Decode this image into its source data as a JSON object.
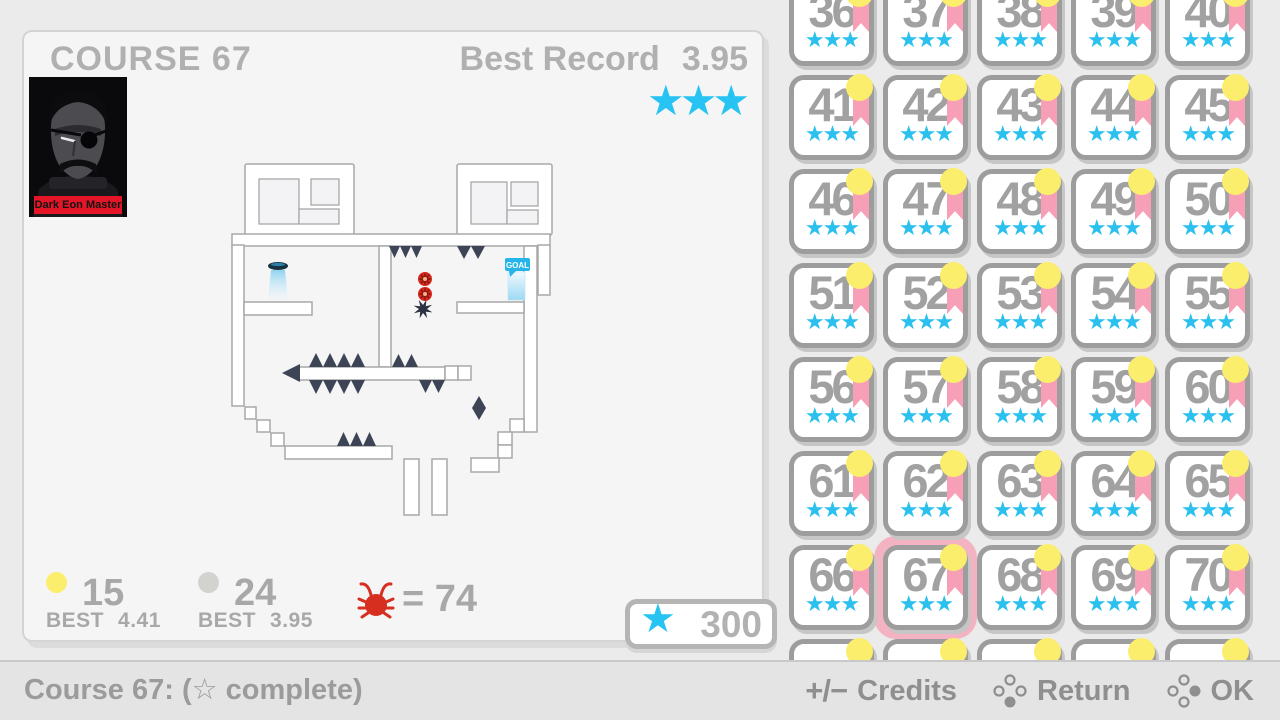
{
  "colors": {
    "accent_cyan": "#27c3f2",
    "medal_yellow": "#fbee6d",
    "medal_silver": "#d2d2cf",
    "ribbon_pink": "#f79fb6",
    "selection_pink": "#f4b3c3",
    "cell_border_gray": "#9d9d9d",
    "text_gray": "#a8a8a8",
    "spike_navy": "#3d4456",
    "mine_red": "#d5271b",
    "banner_red": "#e31527"
  },
  "left_panel": {
    "title": "COURSE 67",
    "best_record_label": "Best Record",
    "best_record_value": "3.95",
    "record_stars": 3,
    "portrait_banner": "Dark Eon Master",
    "map": {
      "goal_label": "GOAL"
    },
    "medals": [
      {
        "type": "gold",
        "count": "15",
        "best_label": "BEST",
        "best_value": "4.41"
      },
      {
        "type": "silver",
        "count": "24",
        "best_label": "BEST",
        "best_value": "3.95"
      }
    ],
    "enemy_count_label": "= 74",
    "star_total": "300"
  },
  "course_grid": {
    "selected": 67,
    "stars_per_cell": 3,
    "star_glyph": "★",
    "numbers": [
      36,
      37,
      38,
      39,
      40,
      41,
      42,
      43,
      44,
      45,
      46,
      47,
      48,
      49,
      50,
      51,
      52,
      53,
      54,
      55,
      56,
      57,
      58,
      59,
      60,
      61,
      62,
      63,
      64,
      65,
      66,
      67,
      68,
      69,
      70
    ],
    "partial_row_count": 5
  },
  "bottom_bar": {
    "status": "Course 67: (☆ complete)",
    "credits_icon": "+/−",
    "credits_label": "Credits",
    "return_label": "Return",
    "ok_label": "OK"
  }
}
